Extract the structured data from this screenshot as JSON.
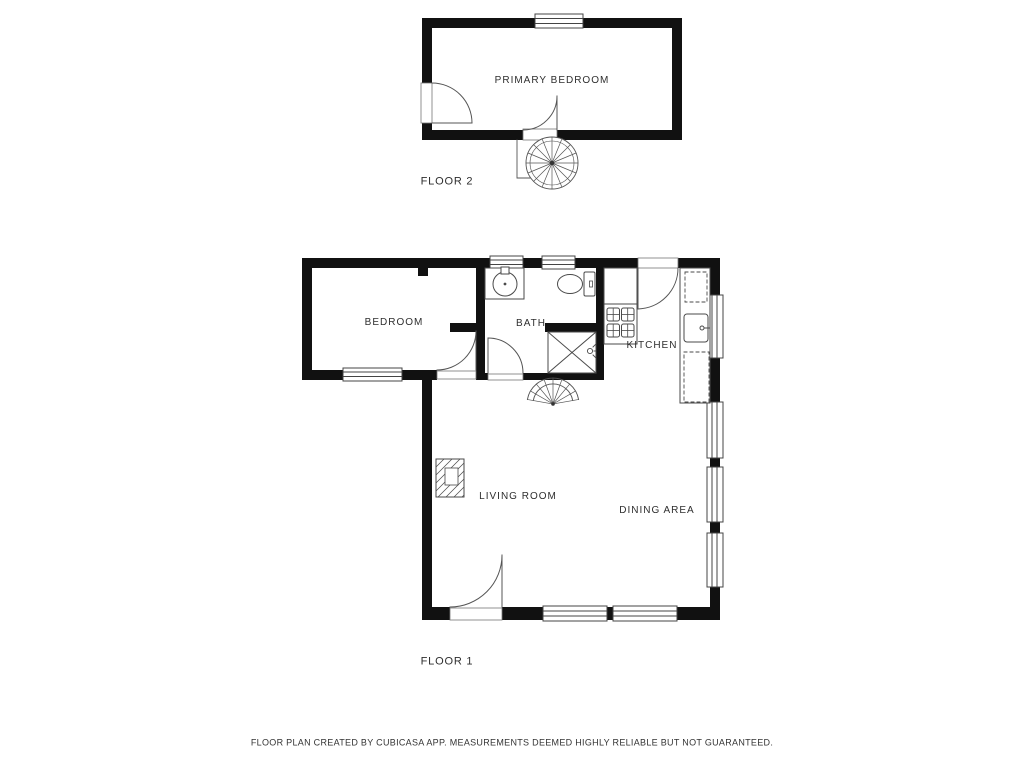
{
  "document": {
    "type": "floor-plan",
    "background_color": "#ffffff",
    "wall_color": "#111111",
    "line_color": "#555555",
    "text_color": "#2e2e2e"
  },
  "floor2": {
    "label": "FLOOR 2",
    "rooms": [
      {
        "name": "PRIMARY BEDROOM"
      }
    ],
    "features": [
      "spiral-staircase",
      "window",
      "door-swing",
      "door-swing"
    ]
  },
  "floor1": {
    "label": "FLOOR 1",
    "rooms": [
      {
        "name": "BEDROOM"
      },
      {
        "name": "BATH"
      },
      {
        "name": "KITCHEN"
      },
      {
        "name": "LIVING ROOM"
      },
      {
        "name": "DINING AREA"
      }
    ],
    "features": [
      "spiral-staircase",
      "shower",
      "toilet",
      "bathroom-sink",
      "kitchen-sink",
      "stove-burners",
      "fireplace",
      "windows",
      "door-swings",
      "dashed-cabinets"
    ]
  },
  "footer": {
    "disclaimer": "FLOOR PLAN CREATED BY CUBICASA APP. MEASUREMENTS DEEMED HIGHLY RELIABLE BUT NOT GUARANTEED."
  }
}
